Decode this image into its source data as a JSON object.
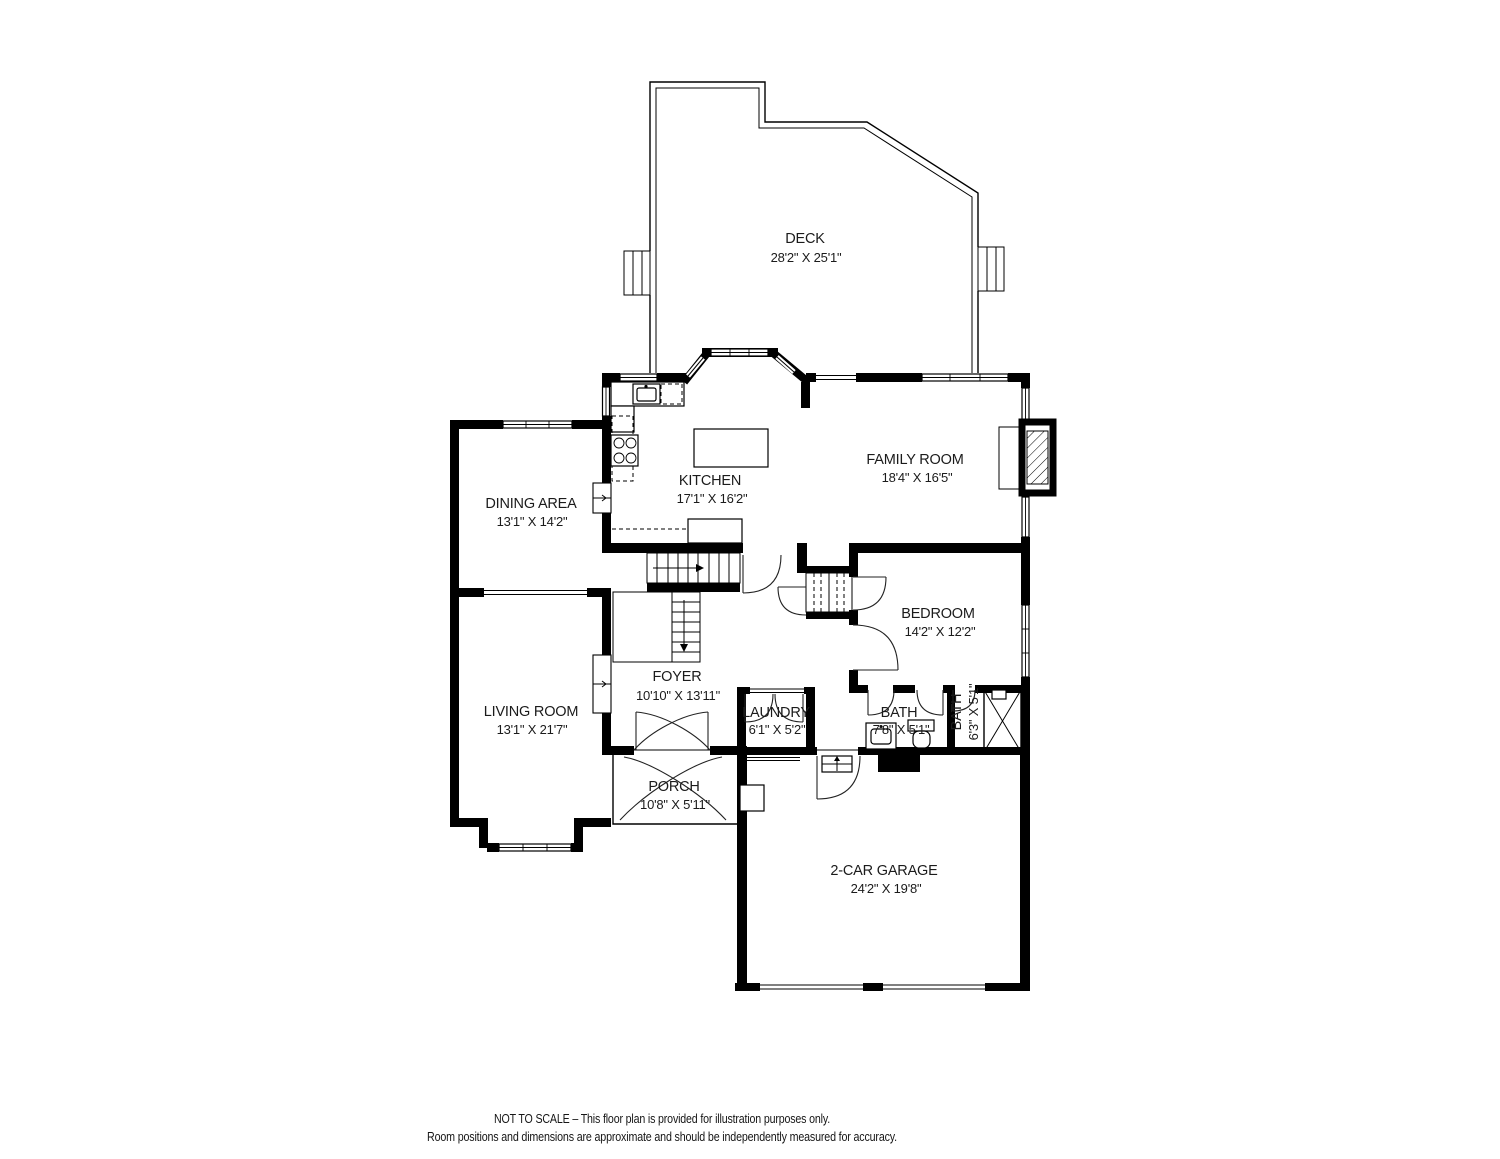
{
  "rooms": [
    {
      "id": "deck",
      "label": "DECK",
      "dims": "28'2\" X 25'1\""
    },
    {
      "id": "kitchen",
      "label": "KITCHEN",
      "dims": "17'1\" X 16'2\""
    },
    {
      "id": "family-room",
      "label": "FAMILY ROOM",
      "dims": "18'4\" X 16'5\""
    },
    {
      "id": "dining-area",
      "label": "DINING AREA",
      "dims": "13'1\" X 14'2\""
    },
    {
      "id": "living-room",
      "label": "LIVING ROOM",
      "dims": "13'1\" X 21'7\""
    },
    {
      "id": "foyer",
      "label": "FOYER",
      "dims": "10'10\" X 13'11\""
    },
    {
      "id": "bedroom",
      "label": "BEDROOM",
      "dims": "14'2\" X 12'2\""
    },
    {
      "id": "laundry",
      "label": "LAUNDRY",
      "dims": "6'1\" X 5'2\""
    },
    {
      "id": "bath",
      "label": "BATH",
      "dims": "7'8\" X 5'1\""
    },
    {
      "id": "bath-2",
      "label": "BATH",
      "dims": "6'3\" X 5'1\""
    },
    {
      "id": "porch",
      "label": "PORCH",
      "dims": "10'8\" X 5'11\""
    },
    {
      "id": "garage",
      "label": "2-CAR GARAGE",
      "dims": "24'2\" X 19'8\""
    }
  ],
  "footer": {
    "line1": "NOT TO SCALE – This floor plan is provided for illustration purposes only.",
    "line2": "Room positions and dimensions are approximate and should be independently measured for accuracy."
  },
  "colors": {
    "wall": "#000000",
    "background": "#ffffff",
    "text": "#1b1b1b"
  }
}
